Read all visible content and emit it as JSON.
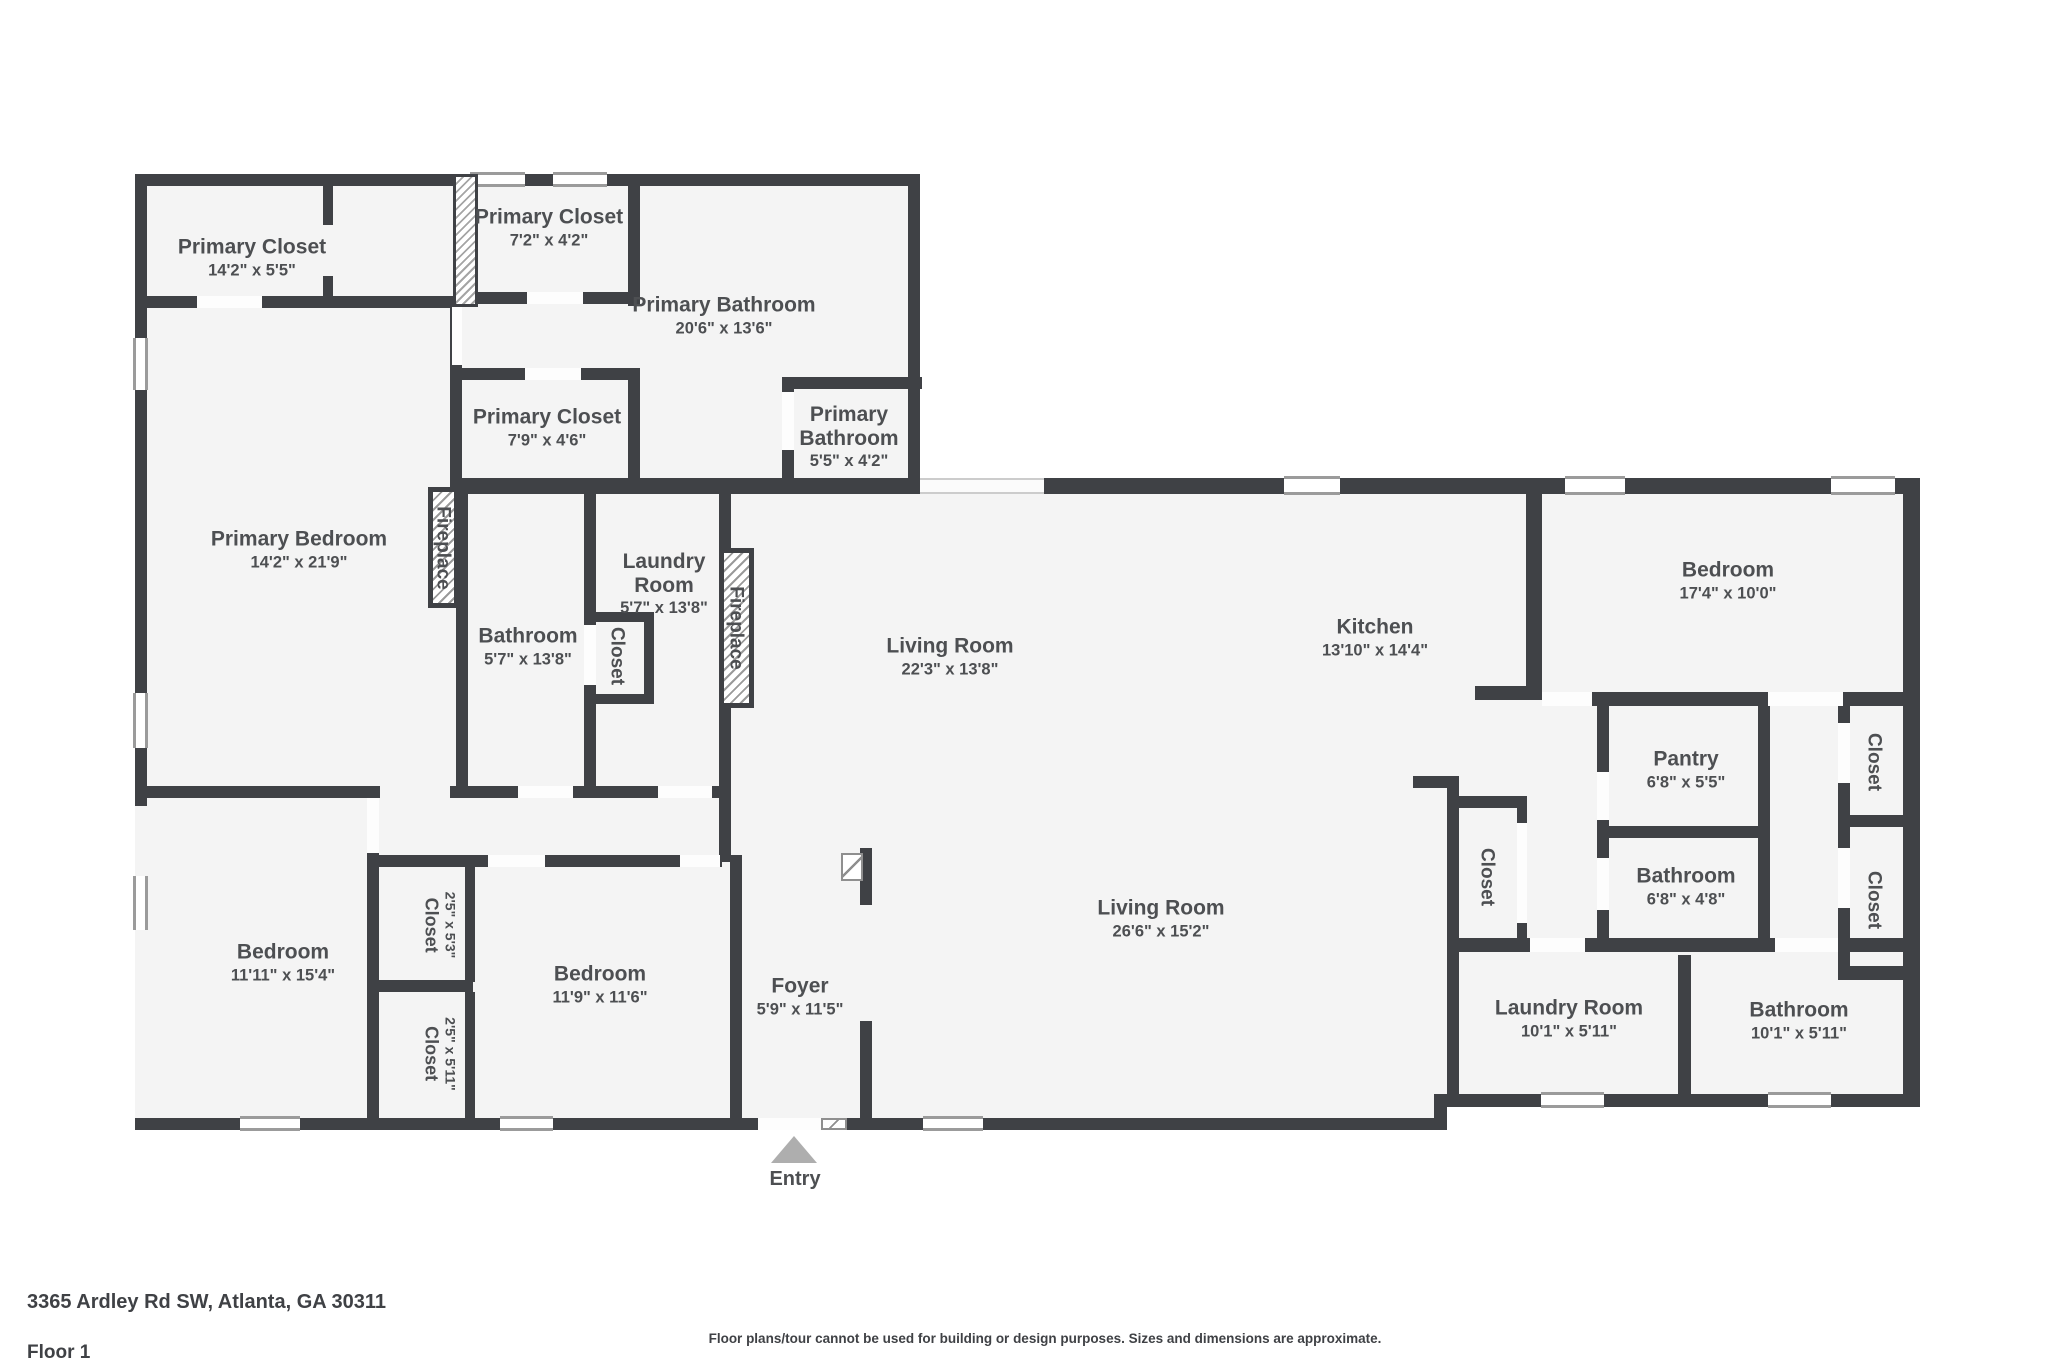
{
  "colors": {
    "wall": "#3f4145",
    "room_fill": "#f4f4f4",
    "label_text": "#4d4f52",
    "window_line": "#9b9b9b",
    "entry_arrow": "#aeaeae"
  },
  "rooms": [
    {
      "id": "primary-closet-1",
      "name": "Primary Closet",
      "dims": "14'2\" x 5'5\""
    },
    {
      "id": "primary-closet-2",
      "name": "Primary Closet",
      "dims": "7'2\" x 4'2\""
    },
    {
      "id": "primary-bathroom-1",
      "name": "Primary Bathroom",
      "dims": "20'6\" x 13'6\""
    },
    {
      "id": "primary-closet-3",
      "name": "Primary Closet",
      "dims": "7'9\" x 4'6\""
    },
    {
      "id": "primary-bathroom-2",
      "name": "Primary Bathroom",
      "dims": "5'5\" x 4'2\""
    },
    {
      "id": "primary-bedroom",
      "name": "Primary Bedroom",
      "dims": "14'2\" x 21'9\""
    },
    {
      "id": "fireplace-1",
      "name": "Fireplace",
      "dims": ""
    },
    {
      "id": "bathroom-1",
      "name": "Bathroom",
      "dims": "5'7\" x 13'8\""
    },
    {
      "id": "laundry-room-1",
      "name": "Laundry Room",
      "dims": "5'7\" x 13'8\""
    },
    {
      "id": "closet-1",
      "name": "Closet",
      "dims": ""
    },
    {
      "id": "fireplace-2",
      "name": "Fireplace",
      "dims": ""
    },
    {
      "id": "living-room-1",
      "name": "Living Room",
      "dims": "22'3\" x 13'8\""
    },
    {
      "id": "kitchen",
      "name": "Kitchen",
      "dims": "13'10\" x 14'4\""
    },
    {
      "id": "bedroom-1",
      "name": "Bedroom",
      "dims": "17'4\" x 10'0\""
    },
    {
      "id": "pantry",
      "name": "Pantry",
      "dims": "6'8\" x 5'5\""
    },
    {
      "id": "closet-2",
      "name": "Closet",
      "dims": ""
    },
    {
      "id": "bathroom-2",
      "name": "Bathroom",
      "dims": "6'8\" x 4'8\""
    },
    {
      "id": "closet-3",
      "name": "Closet",
      "dims": ""
    },
    {
      "id": "closet-4",
      "name": "Closet",
      "dims": ""
    },
    {
      "id": "living-room-2",
      "name": "Living Room",
      "dims": "26'6\" x 15'2\""
    },
    {
      "id": "bedroom-2",
      "name": "Bedroom",
      "dims": "11'11\" x 15'4\""
    },
    {
      "id": "closet-5",
      "name": "Closet",
      "dims": "2'5\" x 5'3\""
    },
    {
      "id": "closet-6",
      "name": "Closet",
      "dims": "2'5\" x 5'11\""
    },
    {
      "id": "bedroom-3",
      "name": "Bedroom",
      "dims": "11'9\" x 11'6\""
    },
    {
      "id": "foyer",
      "name": "Foyer",
      "dims": "5'9\" x 11'5\""
    },
    {
      "id": "laundry-room-2",
      "name": "Laundry Room",
      "dims": "10'1\" x 5'11\""
    },
    {
      "id": "bathroom-3",
      "name": "Bathroom",
      "dims": "10'1\" x 5'11\""
    }
  ],
  "entry": {
    "label": "Entry"
  },
  "footer": {
    "address": "3365 Ardley Rd SW, Atlanta, GA 30311",
    "floor": "Floor 1",
    "disclaimer": "Floor plans/tour cannot be used for building or design purposes. Sizes and dimensions are approximate."
  }
}
